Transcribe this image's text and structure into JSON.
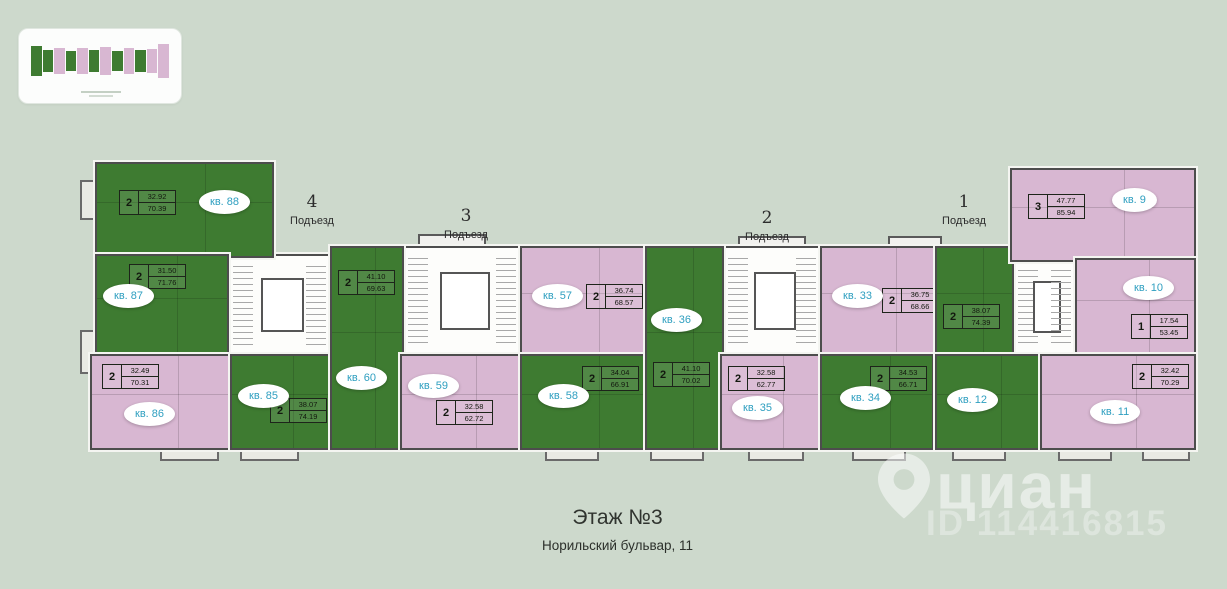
{
  "page": {
    "floor_title": "Этаж №3",
    "address": "Норильский бульвар, 11"
  },
  "watermark": {
    "brand": "циан",
    "id_text": "ID 114416815"
  },
  "entrances": [
    {
      "number": "4",
      "label": "Подъезд"
    },
    {
      "number": "3",
      "label": "Подъезд"
    },
    {
      "number": "2",
      "label": "Подъезд"
    },
    {
      "number": "1",
      "label": "Подъезд"
    }
  ],
  "colors": {
    "background": "#cdd9cc",
    "green": "#3e7b31",
    "pink": "#d8b7d2",
    "wall": "#4d4d4d",
    "label_teal": "#2f9fc0"
  },
  "apartments": [
    {
      "number": "88",
      "label": "кв. 88",
      "rooms": "2",
      "area1": "32.92",
      "area2": "70.39",
      "color": "green"
    },
    {
      "number": "87",
      "label": "кв. 87",
      "rooms": "2",
      "area1": "31.50",
      "area2": "71.76",
      "color": "green"
    },
    {
      "number": "86",
      "label": "кв. 86",
      "rooms": "2",
      "area1": "32.49",
      "area2": "70.31",
      "color": "pink"
    },
    {
      "number": "85",
      "label": "кв. 85",
      "rooms": "2",
      "area1": "38.07",
      "area2": "74.19",
      "color": "green"
    },
    {
      "number": "60",
      "label": "кв. 60",
      "rooms": "2",
      "area1": "41.10",
      "area2": "69.63",
      "color": "green"
    },
    {
      "number": "59",
      "label": "кв. 59",
      "rooms": "2",
      "area1": "32.58",
      "area2": "62.72",
      "color": "pink"
    },
    {
      "number": "57",
      "label": "кв. 57",
      "rooms": "2",
      "area1": "36.74",
      "area2": "68.57",
      "color": "pink"
    },
    {
      "number": "58",
      "label": "кв. 58",
      "rooms": "2",
      "area1": "34.04",
      "area2": "66.91",
      "color": "green"
    },
    {
      "number": "36",
      "label": "кв. 36",
      "rooms": "2",
      "area1": "41.10",
      "area2": "70.02",
      "color": "green"
    },
    {
      "number": "35",
      "label": "кв. 35",
      "rooms": "2",
      "area1": "32.58",
      "area2": "62.77",
      "color": "pink"
    },
    {
      "number": "33",
      "label": "кв. 33",
      "rooms": "2",
      "area1": "36.75",
      "area2": "68.66",
      "color": "pink"
    },
    {
      "number": "34",
      "label": "кв. 34",
      "rooms": "2",
      "area1": "34.53",
      "area2": "66.71",
      "color": "green"
    },
    {
      "number": "12",
      "label": "кв. 12",
      "rooms": "2",
      "area1": "38.07",
      "area2": "74.39",
      "color": "green"
    },
    {
      "number": "9",
      "label": "кв. 9",
      "rooms": "3",
      "area1": "47.77",
      "area2": "85.94",
      "color": "pink"
    },
    {
      "number": "10",
      "label": "кв. 10",
      "rooms": "1",
      "area1": "17.54",
      "area2": "53.45",
      "color": "pink"
    },
    {
      "number": "11",
      "label": "кв. 11",
      "rooms": "2",
      "area1": "32.42",
      "area2": "70.29",
      "color": "pink"
    }
  ]
}
